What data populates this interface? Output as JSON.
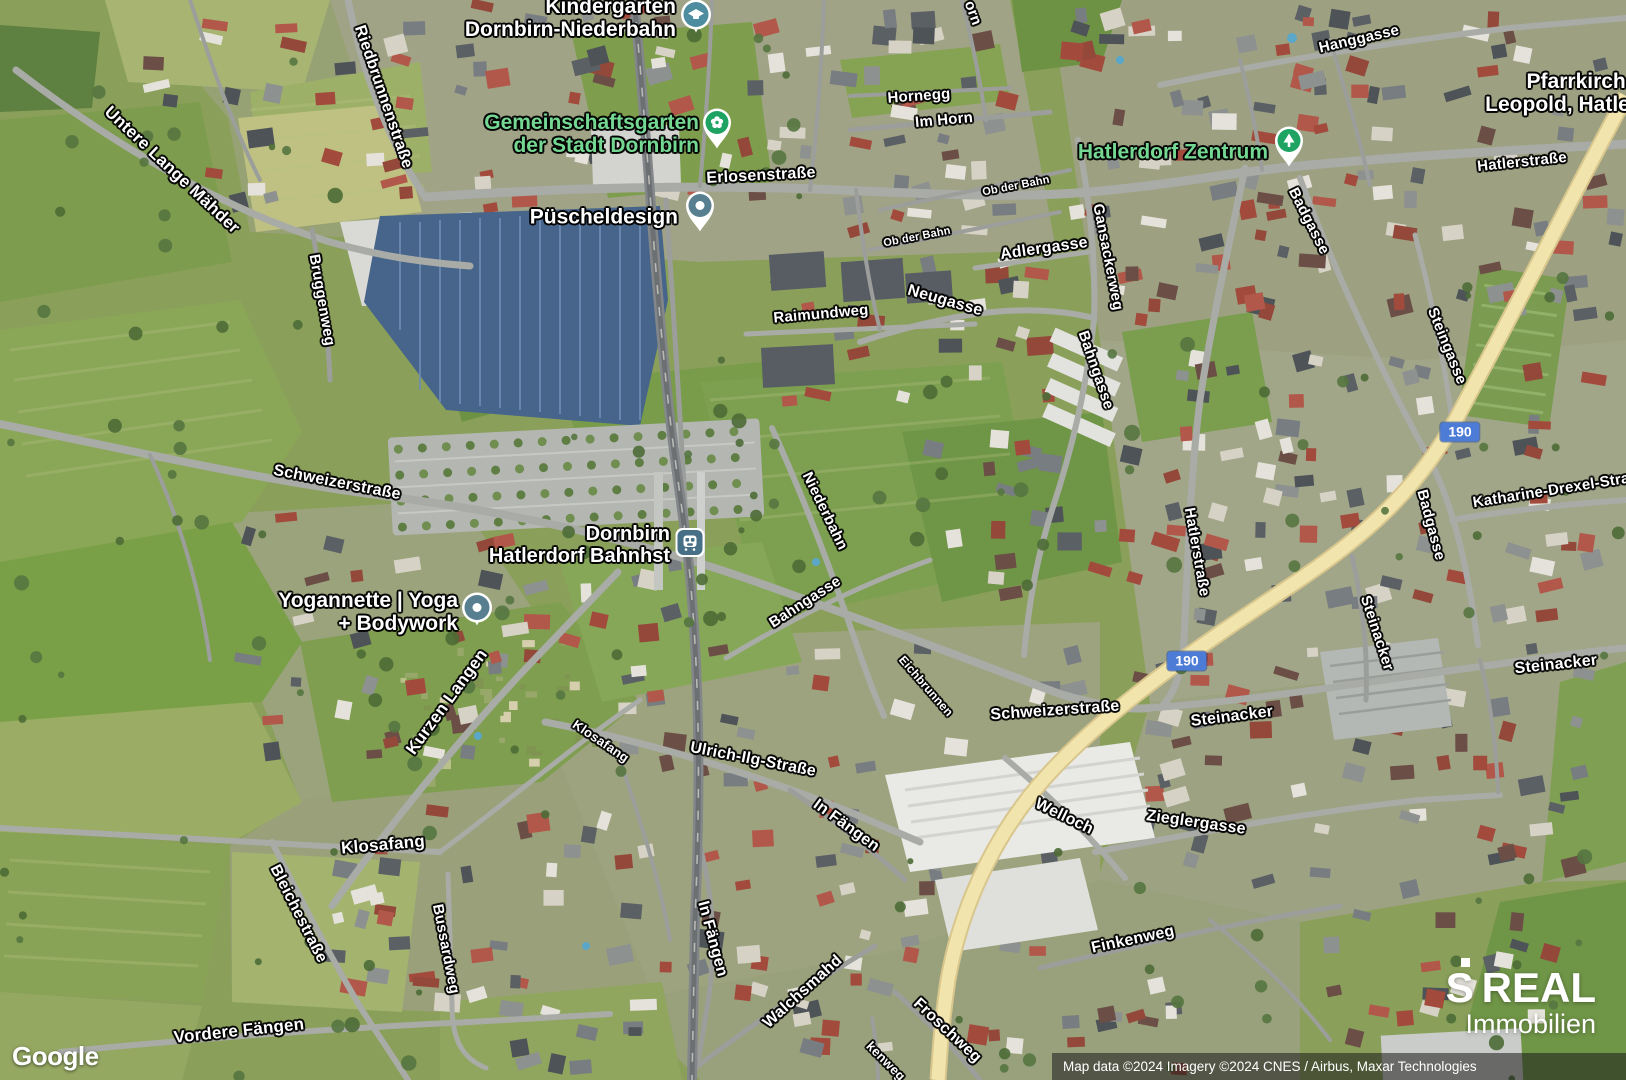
{
  "map": {
    "type": "satellite",
    "location": "Dornbirn Hatlerdorf",
    "provider_logo": "Google",
    "attribution": "Map data ©2024 Imagery ©2024 CNES / Airbus, Maxar Technologies",
    "watermark": {
      "s": "S",
      "brand": "REAL",
      "sub": "Immobilien"
    },
    "colors": {
      "poi_green_text": "#74d893",
      "poi_white_text": "#ffffff",
      "route_badge_blue": "#4d7cd6",
      "pin_green": "#1ea362",
      "pin_slate": "#587f90",
      "pin_school_teal": "#4e8ca0",
      "pin_station_blue": "#476f85",
      "highway_yellow": "#f1e5ad"
    },
    "route_badges": [
      {
        "label": "190",
        "x": 1460,
        "y": 432
      },
      {
        "label": "190",
        "x": 1187,
        "y": 661
      }
    ],
    "poi_labels": [
      {
        "id": "kindergarten",
        "lines": [
          "Kindergarten",
          "Dornbirn-Niederbahn"
        ],
        "x": 676,
        "y": 18,
        "align": "right",
        "color": "#ffffff",
        "size": 21,
        "pin": {
          "icon": "school-icon",
          "shape": "round",
          "color": "#4e8ca0",
          "x": 696,
          "y": 17
        }
      },
      {
        "id": "gemeinschaftsgarten",
        "lines": [
          "Gemeinschaftsgarten",
          "der Stadt Dornbirn"
        ],
        "x": 699,
        "y": 134,
        "align": "right",
        "color": "#74d893",
        "size": 21,
        "pin": {
          "icon": "flower-icon",
          "shape": "teardrop",
          "color": "#1ea362",
          "x": 717,
          "y": 130
        }
      },
      {
        "id": "puescheldesign",
        "lines": [
          "Püscheldesign"
        ],
        "x": 678,
        "y": 217,
        "align": "right",
        "color": "#ffffff",
        "size": 21,
        "pin": {
          "icon": "dot-icon",
          "shape": "teardrop",
          "color": "#587f90",
          "x": 700,
          "y": 213
        }
      },
      {
        "id": "hatlerdorf-zentrum",
        "lines": [
          "Hatlerdorf Zentrum"
        ],
        "x": 1268,
        "y": 152,
        "align": "right",
        "color": "#74d893",
        "size": 21,
        "pin": {
          "icon": "tree-icon",
          "shape": "teardrop",
          "color": "#1ea362",
          "x": 1289,
          "y": 148
        }
      },
      {
        "id": "bahnhst",
        "lines": [
          "Dornbirn",
          "Hatlerdorf Bahnhst"
        ],
        "x": 670,
        "y": 545,
        "align": "right",
        "color": "#ffffff",
        "size": 20,
        "pin": {
          "icon": "train-icon",
          "shape": "square",
          "color": "#476f85",
          "x": 690,
          "y": 545
        }
      },
      {
        "id": "yogannette",
        "lines": [
          "Yogannette | Yoga",
          "+ Bodywork"
        ],
        "x": 458,
        "y": 612,
        "align": "right",
        "color": "#ffffff",
        "size": 21,
        "pin": {
          "icon": "dot-icon",
          "shape": "round",
          "color": "#587f90",
          "x": 477,
          "y": 610
        }
      },
      {
        "id": "pfarrkirche",
        "lines": [
          "Pfarrkirche",
          "Leopold, Hatlerdorf"
        ],
        "x": 1582,
        "y": 93,
        "align": "center",
        "color": "#ffffff",
        "size": 21,
        "pin": null
      }
    ],
    "street_labels": [
      {
        "text": "Untere Lange Mähder",
        "x": 172,
        "y": 170,
        "rot": 43,
        "size": 17
      },
      {
        "text": "Riedbrunnenstraße",
        "x": 383,
        "y": 97,
        "rot": 71,
        "size": 16
      },
      {
        "text": "Bruggenweg",
        "x": 322,
        "y": 300,
        "rot": 80,
        "size": 15
      },
      {
        "text": "Hornegg",
        "x": 919,
        "y": 96,
        "rot": -4,
        "size": 15
      },
      {
        "text": "Im Horn",
        "x": 944,
        "y": 120,
        "rot": -5,
        "size": 15
      },
      {
        "text": "orn",
        "x": 973,
        "y": 13,
        "rot": 70,
        "size": 15
      },
      {
        "text": "Erlosenstraße",
        "x": 761,
        "y": 176,
        "rot": -3,
        "size": 16
      },
      {
        "text": "Ob der Bahn",
        "x": 1016,
        "y": 186,
        "rot": -11,
        "size": 11
      },
      {
        "text": "Ob der Bahn",
        "x": 917,
        "y": 237,
        "rot": -11,
        "size": 11
      },
      {
        "text": "Adlergasse",
        "x": 1044,
        "y": 249,
        "rot": -8,
        "size": 16
      },
      {
        "text": "Gansackerweg",
        "x": 1108,
        "y": 257,
        "rot": 79,
        "size": 15
      },
      {
        "text": "Neugasse",
        "x": 945,
        "y": 301,
        "rot": 16,
        "size": 16
      },
      {
        "text": "Raimundweg",
        "x": 821,
        "y": 314,
        "rot": -5,
        "size": 15
      },
      {
        "text": "Hanggasse",
        "x": 1359,
        "y": 39,
        "rot": -13,
        "size": 15
      },
      {
        "text": "Badgasse",
        "x": 1309,
        "y": 221,
        "rot": 63,
        "size": 15
      },
      {
        "text": "Hatlerstraße",
        "x": 1522,
        "y": 162,
        "rot": -6,
        "size": 15
      },
      {
        "text": "Steingasse",
        "x": 1447,
        "y": 346,
        "rot": 68,
        "size": 15
      },
      {
        "text": "Niederbahn",
        "x": 825,
        "y": 511,
        "rot": 64,
        "size": 15
      },
      {
        "text": "Bahngasse",
        "x": 1096,
        "y": 370,
        "rot": 71,
        "size": 15
      },
      {
        "text": "Bahngasse",
        "x": 805,
        "y": 602,
        "rot": -33,
        "size": 15
      },
      {
        "text": "Hatlerstraße",
        "x": 1197,
        "y": 552,
        "rot": 80,
        "size": 15
      },
      {
        "text": "Badgasse",
        "x": 1431,
        "y": 525,
        "rot": 75,
        "size": 15
      },
      {
        "text": "Katharine-Drexel-Straße",
        "x": 1560,
        "y": 489,
        "rot": -9,
        "size": 15
      },
      {
        "text": "Steinacker",
        "x": 1377,
        "y": 633,
        "rot": 72,
        "size": 15
      },
      {
        "text": "Steinacker",
        "x": 1556,
        "y": 665,
        "rot": -6,
        "size": 16
      },
      {
        "text": "Steinacker",
        "x": 1232,
        "y": 717,
        "rot": -7,
        "size": 16
      },
      {
        "text": "Schweizerstraße",
        "x": 337,
        "y": 483,
        "rot": 11,
        "size": 16
      },
      {
        "text": "Schweizerstraße",
        "x": 1055,
        "y": 711,
        "rot": -4,
        "size": 16
      },
      {
        "text": "Eichbrunnen",
        "x": 926,
        "y": 686,
        "rot": 49,
        "size": 12
      },
      {
        "text": "Welloch",
        "x": 1064,
        "y": 817,
        "rot": 26,
        "size": 16
      },
      {
        "text": "Zieglergasse",
        "x": 1196,
        "y": 823,
        "rot": 8,
        "size": 16
      },
      {
        "text": "Ulrich-Ilg-Straße",
        "x": 753,
        "y": 760,
        "rot": 11,
        "size": 16
      },
      {
        "text": "In Fängen",
        "x": 846,
        "y": 826,
        "rot": 36,
        "size": 16
      },
      {
        "text": "In Fängen",
        "x": 712,
        "y": 939,
        "rot": 75,
        "size": 16
      },
      {
        "text": "Kurzen Langen",
        "x": 447,
        "y": 702,
        "rot": -54,
        "size": 17
      },
      {
        "text": "Walchsmahd",
        "x": 803,
        "y": 992,
        "rot": -42,
        "size": 16
      },
      {
        "text": "Froschweg",
        "x": 947,
        "y": 1031,
        "rot": 43,
        "size": 16
      },
      {
        "text": "Finkenweg",
        "x": 1133,
        "y": 940,
        "rot": -12,
        "size": 16
      },
      {
        "text": "kenweg",
        "x": 886,
        "y": 1061,
        "rot": 45,
        "size": 13
      },
      {
        "text": "Klosafang",
        "x": 601,
        "y": 741,
        "rot": 34,
        "size": 13
      },
      {
        "text": "Klosafang",
        "x": 383,
        "y": 845,
        "rot": -5,
        "size": 17
      },
      {
        "text": "Bleichestraße",
        "x": 298,
        "y": 914,
        "rot": 63,
        "size": 16
      },
      {
        "text": "Bussardweg",
        "x": 446,
        "y": 949,
        "rot": 79,
        "size": 15
      },
      {
        "text": "Vordere Fängen",
        "x": 239,
        "y": 1031,
        "rot": -6,
        "size": 17
      }
    ]
  }
}
